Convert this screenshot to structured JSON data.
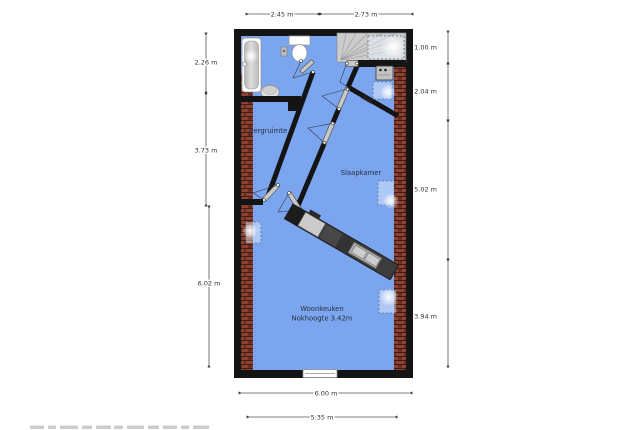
{
  "plan": {
    "rooms": {
      "bergruimte": {
        "label": "Bergruimte"
      },
      "slaapkamer": {
        "label": "Slaapkamer"
      },
      "woonkeuken": {
        "label": "Woonkeuken",
        "sublabel": "Nokhoogte 3.42m"
      }
    },
    "dimensions": {
      "top": [
        {
          "label": "2.45 m"
        },
        {
          "label": "2.73 m"
        }
      ],
      "left": [
        {
          "label": "2.26 m"
        },
        {
          "label": "3.73 m"
        },
        {
          "label": "6.02 m"
        }
      ],
      "right": [
        {
          "label": "1.00 m"
        },
        {
          "label": "2.04 m"
        },
        {
          "label": "5.02 m"
        },
        {
          "label": "3.94 m"
        }
      ],
      "bottom": [
        {
          "label": "6.00 m"
        },
        {
          "label": "5.35 m"
        }
      ]
    },
    "colors": {
      "floor": "#7ba5ee",
      "wall": "#141414",
      "brick": "#8e4130",
      "stairs": "#cccccc",
      "counter": "#3c3c3c",
      "dimension_text": "#333333"
    },
    "fixtures": [
      "bathtub",
      "toilet",
      "washbasin",
      "stairs",
      "boiler",
      "kitchen-counter",
      "double-sink",
      "window",
      "roof-windows"
    ]
  }
}
